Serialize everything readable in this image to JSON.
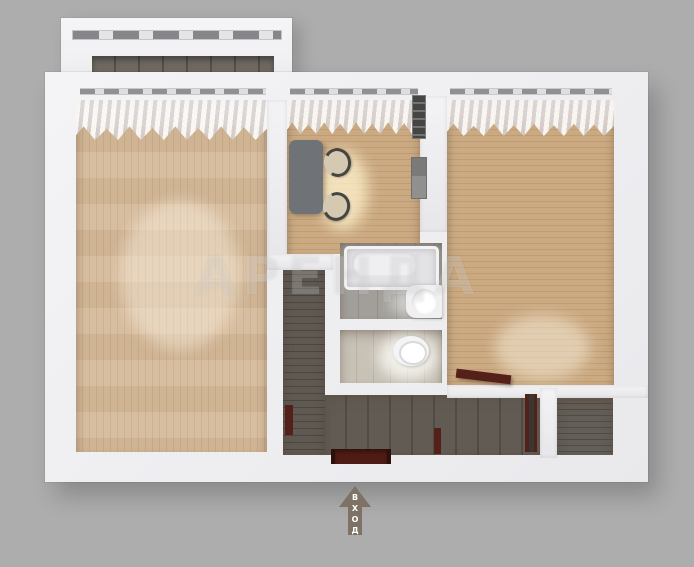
{
  "scene": {
    "type": "3d-floorplan-top-view",
    "background_color": "#adadad",
    "wall_color": "#f2f2f4",
    "wood_floor_color": "#cbaa82",
    "wood_floor_light_color": "#d6bb9b",
    "dark_hall_floor_color": "#5f5952",
    "balcony_floor_color": "#6f6962",
    "bath_tile_color": "#a29f9a",
    "toilet_tile_color": "#c7c1b6",
    "door_color": "#54201a",
    "kitchen_table_color": "#6f7378",
    "arrow_color": "#7d7265"
  },
  "watermark": {
    "text": "АРЕНДА"
  },
  "entrance": {
    "label": "ВХОД",
    "direction": "up"
  }
}
